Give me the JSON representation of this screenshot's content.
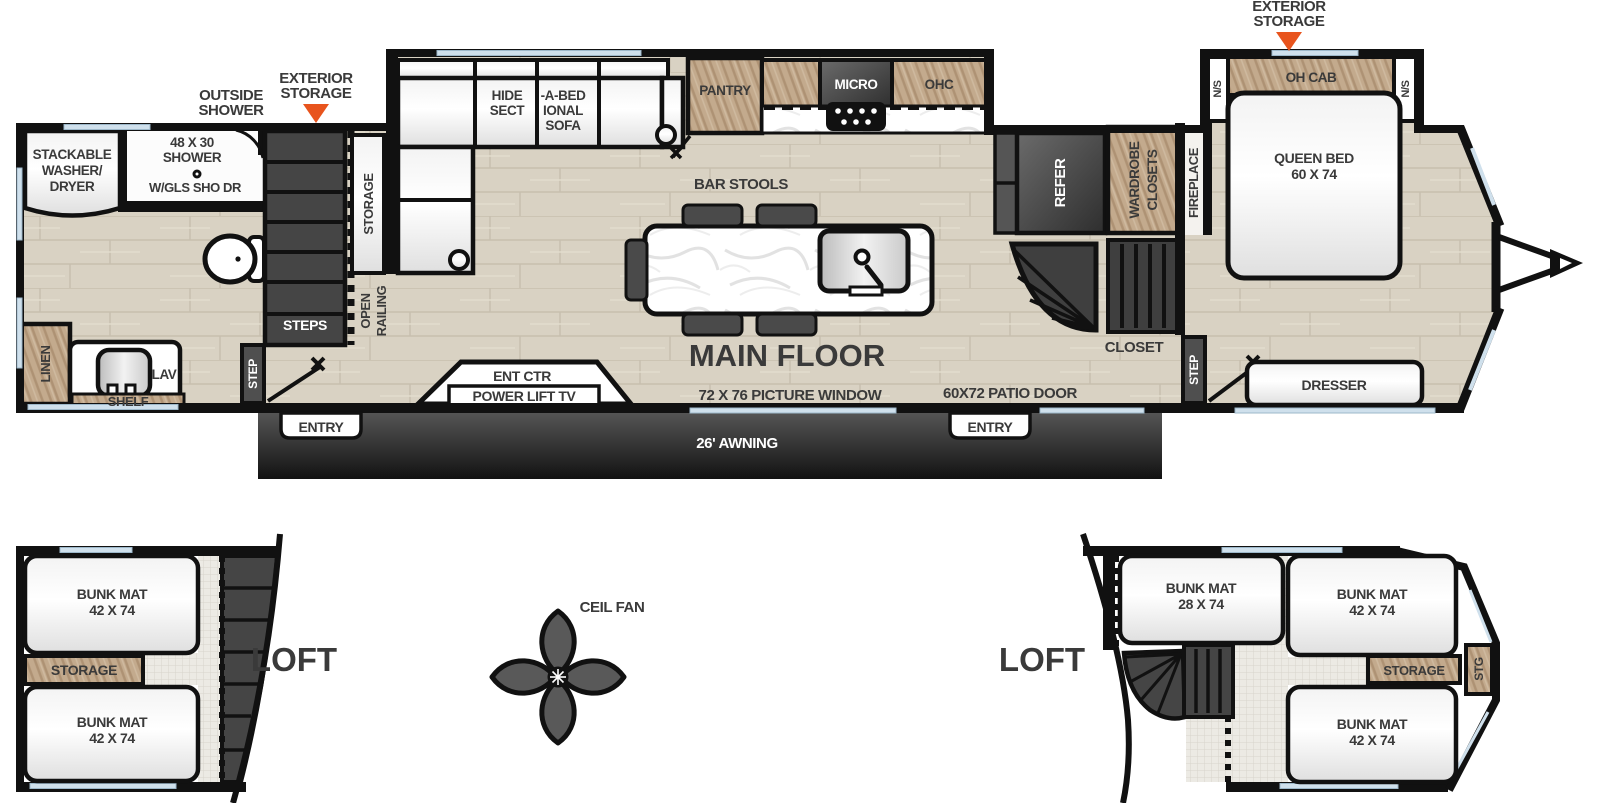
{
  "colors": {
    "wall": "#111111",
    "floor_wood": "#d9d2c3",
    "cabinet_wood": "#c3aa8d",
    "appliance_dark": "#4a4a4a",
    "accent_orange": "#e8541d",
    "window_blue": "#cfe0ec",
    "label_dark": "#3a3a3a",
    "awning_dark": "#1c1c1c"
  },
  "main": {
    "title": "MAIN FLOOR",
    "ext": {
      "outside_shower_1": "OUTSIDE",
      "outside_shower_2": "SHOWER",
      "storage_left_1": "EXTERIOR",
      "storage_left_2": "STORAGE",
      "storage_right_1": "EXTERIOR",
      "storage_right_2": "STORAGE"
    },
    "bath": {
      "washer_1": "STACKABLE",
      "washer_2": "WASHER/",
      "washer_3": "DRYER",
      "shower_1": "48 X 30",
      "shower_2": "SHOWER",
      "shower_3": "W/GLS SHO DR",
      "linen": "LINEN",
      "lav": "LAV",
      "shelf": "SHELF"
    },
    "stairs": {
      "steps": "STEPS",
      "step_left": "STEP",
      "open_railing_1": "OPEN",
      "open_railing_2": "RAILING",
      "sofa_storage": "STORAGE"
    },
    "sofa": {
      "t1": "HIDE",
      "t2": "SECT",
      "t3": "-A-BED",
      "t4": "IONAL",
      "t5": "SOFA"
    },
    "kitchen": {
      "pantry": "PANTRY",
      "micro": "MICRO",
      "ohc": "OHC",
      "bar_stools": "BAR STOOLS"
    },
    "tv": {
      "t1": "ENT CTR",
      "t2": "POWER LIFT TV"
    },
    "openings": {
      "picture_window": "72 X 76 PICTURE WINDOW",
      "patio_door": "60X72 PATIO DOOR"
    },
    "awning": {
      "label": "26' AWNING",
      "entry_left": "ENTRY",
      "entry_right": "ENTRY"
    },
    "bedroom": {
      "refer": "REFER",
      "wardrobe_1": "WARDROBE",
      "wardrobe_2": "CLOSETS",
      "fireplace": "FIREPLACE",
      "closet": "CLOSET",
      "step": "STEP",
      "ns_left": "N/S",
      "ns_right": "N/S",
      "oh_cab": "OH CAB",
      "bed_1": "QUEEN BED",
      "bed_2": "60 X 74",
      "dresser": "DRESSER"
    }
  },
  "loft_left": {
    "label": "LOFT",
    "bunk1_1": "BUNK MAT",
    "bunk1_2": "42 X 74",
    "storage": "STORAGE",
    "bunk2_1": "BUNK MAT",
    "bunk2_2": "42 X 74"
  },
  "fan": {
    "label": "CEIL FAN"
  },
  "loft_right": {
    "label": "LOFT",
    "bunk1_1": "BUNK MAT",
    "bunk1_2": "28 X 74",
    "bunk2_1": "BUNK MAT",
    "bunk2_2": "42 X 74",
    "storage": "STORAGE",
    "stg": "STG",
    "bunk3_1": "BUNK MAT",
    "bunk3_2": "42 X 74"
  }
}
